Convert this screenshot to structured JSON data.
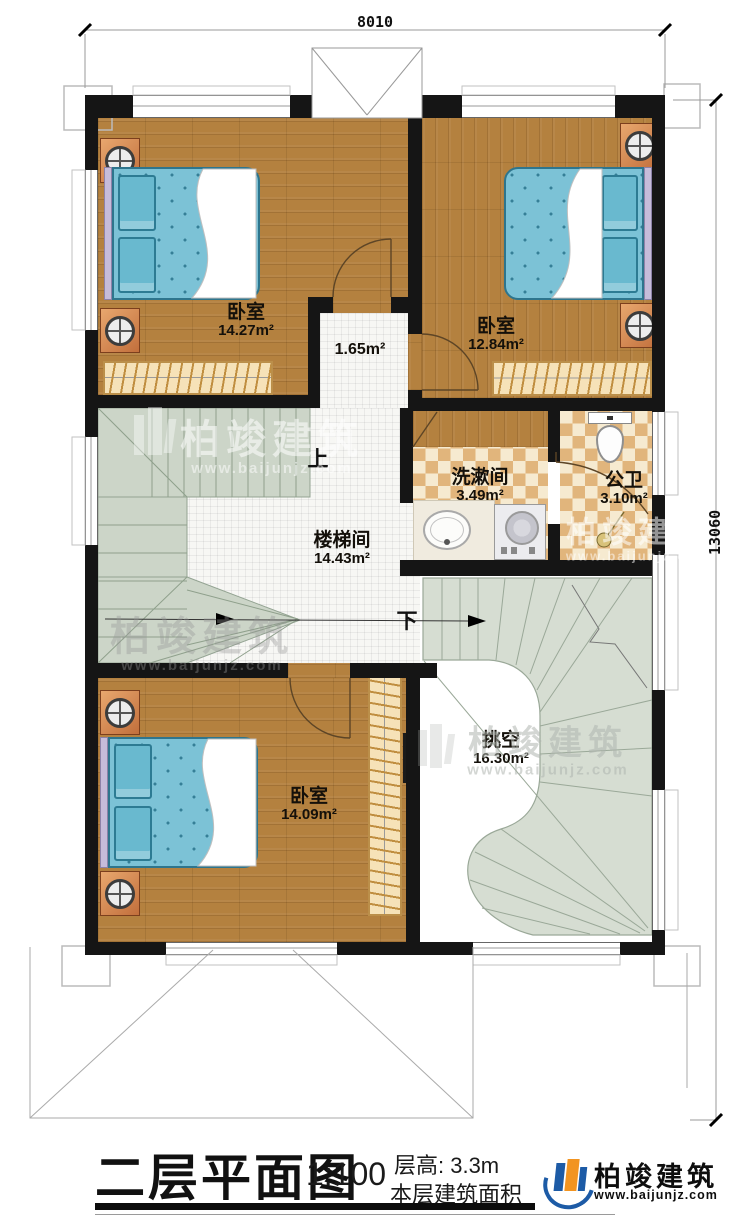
{
  "dimensions": {
    "top": "8010",
    "right": "13060"
  },
  "rooms": {
    "bedroom_tl": {
      "name": "卧室",
      "area": "14.27m²"
    },
    "bedroom_tr": {
      "name": "卧室",
      "area": "12.84m²"
    },
    "bedroom_bl": {
      "name": "卧室",
      "area": "14.09m²"
    },
    "corridor": {
      "area": "1.65m²"
    },
    "stairwell": {
      "name": "楼梯间",
      "area": "14.43m²"
    },
    "washroom": {
      "name": "洗漱间",
      "area": "3.49m²"
    },
    "toilet": {
      "name": "公卫",
      "area": "3.10m²"
    },
    "void": {
      "name": "挑空",
      "area": "16.30m²"
    }
  },
  "stair_labels": {
    "up": "上",
    "down": "下"
  },
  "watermark": {
    "brand": "柏竣建筑",
    "url": "www.baijunjz.com"
  },
  "titlebar": {
    "title": "二层平面图",
    "scale": "1:100",
    "floor_height": "层高: 3.3m",
    "area_caption": "本层建筑面积",
    "logo_brand": "柏竣建筑",
    "logo_url": "www.baijunjz.com"
  },
  "colors": {
    "wall": "#151515",
    "wood": "#b4813f",
    "bed_blue": "#7cc2d6",
    "stair_green": "#ccd5c8",
    "stair_curved": "#d6ddd2",
    "checker_tan": "#e1b57c",
    "logo_blue": "#1d5ba6",
    "logo_orange": "#f29421"
  }
}
